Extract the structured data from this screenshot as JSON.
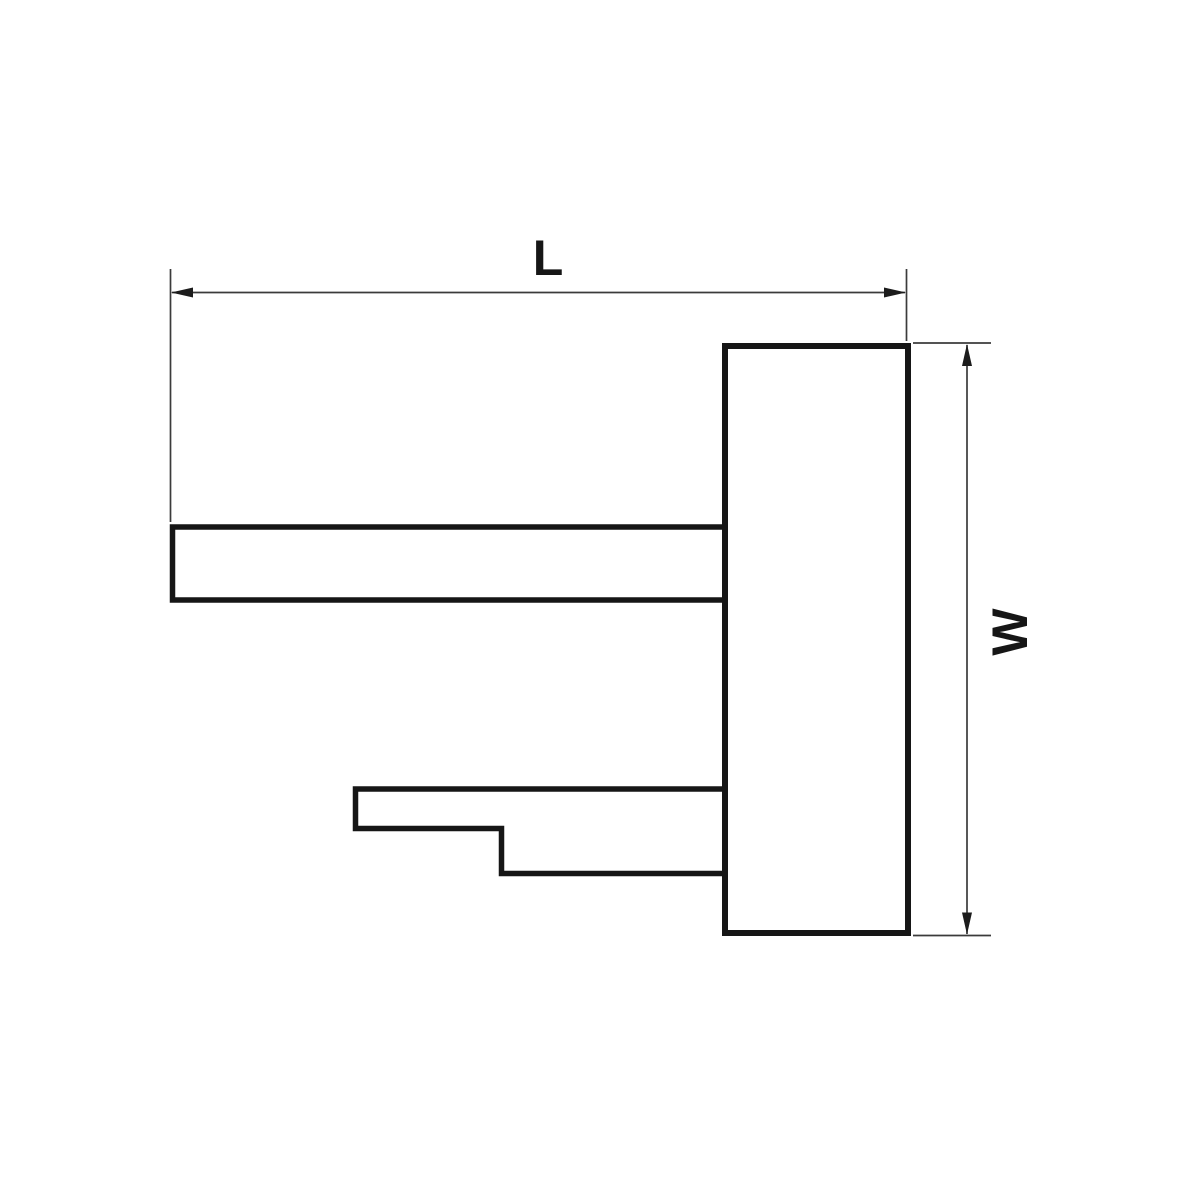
{
  "drawing": {
    "background": "#ffffff",
    "line_color": "#161616",
    "dim_line_color": "#3b3b3b",
    "arrow_color": "#1c1c1c",
    "dimensions": {
      "length": {
        "label": "L"
      },
      "width": {
        "label": "W"
      }
    }
  }
}
